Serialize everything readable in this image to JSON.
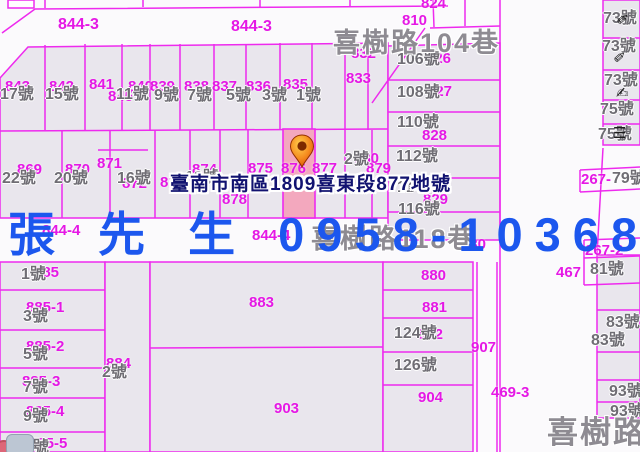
{
  "colors": {
    "bg": "#fbfafc",
    "line": "#ee2aee",
    "parcel_fill": "#e9e6ed",
    "highlight_fill": "#f3a8be",
    "parcel_label": "#e518e5",
    "house_label": "#6f6d74",
    "street_label": "#8e8b92",
    "overlay_blue": "#1c57ee",
    "tooltip_text": "#111270",
    "marker_orange": "#f07818"
  },
  "map": {
    "streets": [
      {
        "label": "喜樹路104巷",
        "x": 333,
        "y": 30,
        "size": 27
      },
      {
        "label": "喜樹路118巷",
        "x": 311,
        "y": 226,
        "size": 27
      },
      {
        "label": "喜樹路",
        "x": 547,
        "y": 417,
        "size": 31
      }
    ],
    "parcel_labels": [
      {
        "t": "844-3",
        "x": 58,
        "y": 17,
        "s": 16
      },
      {
        "t": "844-3",
        "x": 231,
        "y": 19,
        "s": 16
      },
      {
        "t": "843",
        "x": 5,
        "y": 79
      },
      {
        "t": "842",
        "x": 49,
        "y": 79
      },
      {
        "t": "841",
        "x": 89,
        "y": 77
      },
      {
        "t": "845",
        "x": 108,
        "y": 89
      },
      {
        "t": "840",
        "x": 128,
        "y": 79
      },
      {
        "t": "839",
        "x": 150,
        "y": 79
      },
      {
        "t": "838",
        "x": 184,
        "y": 79
      },
      {
        "t": "837",
        "x": 212,
        "y": 79
      },
      {
        "t": "836",
        "x": 246,
        "y": 79
      },
      {
        "t": "835",
        "x": 283,
        "y": 77
      },
      {
        "t": "832",
        "x": 351,
        "y": 46
      },
      {
        "t": "833",
        "x": 346,
        "y": 71
      },
      {
        "t": "824",
        "x": 421,
        "y": -4
      },
      {
        "t": "810",
        "x": 402,
        "y": 13
      },
      {
        "t": "826",
        "x": 426,
        "y": 51
      },
      {
        "t": "827",
        "x": 427,
        "y": 84
      },
      {
        "t": "828",
        "x": 422,
        "y": 128
      },
      {
        "t": "829",
        "x": 423,
        "y": 192
      },
      {
        "t": "830",
        "x": 461,
        "y": 237
      },
      {
        "t": "869",
        "x": 17,
        "y": 162
      },
      {
        "t": "870",
        "x": 65,
        "y": 162
      },
      {
        "t": "871",
        "x": 97,
        "y": 156
      },
      {
        "t": "872",
        "x": 122,
        "y": 176
      },
      {
        "t": "873",
        "x": 160,
        "y": 175
      },
      {
        "t": "874",
        "x": 192,
        "y": 162
      },
      {
        "t": "875",
        "x": 248,
        "y": 161
      },
      {
        "t": "876",
        "x": 281,
        "y": 161
      },
      {
        "t": "877",
        "x": 312,
        "y": 161
      },
      {
        "t": "878",
        "x": 222,
        "y": 192
      },
      {
        "t": "879",
        "x": 366,
        "y": 161
      },
      {
        "t": "880",
        "x": 354,
        "y": 151
      },
      {
        "t": "844-4",
        "x": 42,
        "y": 223
      },
      {
        "t": "844-4",
        "x": 252,
        "y": 228
      },
      {
        "t": "885",
        "x": 34,
        "y": 265
      },
      {
        "t": "885-1",
        "x": 26,
        "y": 300
      },
      {
        "t": "885-2",
        "x": 26,
        "y": 339
      },
      {
        "t": "885-3",
        "x": 22,
        "y": 374
      },
      {
        "t": "885-4",
        "x": 26,
        "y": 404
      },
      {
        "t": "885-5",
        "x": 29,
        "y": 436
      },
      {
        "t": "884",
        "x": 106,
        "y": 356
      },
      {
        "t": "883",
        "x": 249,
        "y": 295
      },
      {
        "t": "903",
        "x": 274,
        "y": 401
      },
      {
        "t": "880",
        "x": 421,
        "y": 268
      },
      {
        "t": "881",
        "x": 422,
        "y": 300
      },
      {
        "t": "882",
        "x": 418,
        "y": 327
      },
      {
        "t": "904",
        "x": 418,
        "y": 390
      },
      {
        "t": "907",
        "x": 471,
        "y": 340
      },
      {
        "t": "469-3",
        "x": 491,
        "y": 385
      },
      {
        "t": "467",
        "x": 556,
        "y": 265
      },
      {
        "t": "267-2",
        "x": 585,
        "y": 243
      },
      {
        "t": "267-",
        "x": 581,
        "y": 172
      }
    ],
    "house_labels": [
      {
        "t": "17號",
        "x": 0,
        "y": 87
      },
      {
        "t": "15號",
        "x": 45,
        "y": 87
      },
      {
        "t": "11號",
        "x": 116,
        "y": 87
      },
      {
        "t": "9號",
        "x": 154,
        "y": 88
      },
      {
        "t": "7號",
        "x": 187,
        "y": 88
      },
      {
        "t": "5號",
        "x": 226,
        "y": 88
      },
      {
        "t": "3號",
        "x": 262,
        "y": 88
      },
      {
        "t": "1號",
        "x": 296,
        "y": 88
      },
      {
        "t": "22號",
        "x": 2,
        "y": 171
      },
      {
        "t": "20號",
        "x": 54,
        "y": 171
      },
      {
        "t": "16號",
        "x": 117,
        "y": 171
      },
      {
        "t": "12號",
        "x": 185,
        "y": 170
      },
      {
        "t": "2號",
        "x": 344,
        "y": 152
      },
      {
        "t": "106號",
        "x": 397,
        "y": 52
      },
      {
        "t": "108號",
        "x": 397,
        "y": 85
      },
      {
        "t": "110號",
        "x": 397,
        "y": 115
      },
      {
        "t": "112號",
        "x": 396,
        "y": 149
      },
      {
        "t": "114號",
        "x": 397,
        "y": 180
      },
      {
        "t": "116號",
        "x": 398,
        "y": 202
      },
      {
        "t": "124號",
        "x": 394,
        "y": 326
      },
      {
        "t": "126號",
        "x": 394,
        "y": 358
      },
      {
        "t": "1號",
        "x": 21,
        "y": 267
      },
      {
        "t": "3號",
        "x": 23,
        "y": 309
      },
      {
        "t": "5號",
        "x": 23,
        "y": 347
      },
      {
        "t": "7號",
        "x": 23,
        "y": 380
      },
      {
        "t": "9號",
        "x": 23,
        "y": 409
      },
      {
        "t": "11號",
        "x": 16,
        "y": 440
      },
      {
        "t": "2號",
        "x": 102,
        "y": 365
      },
      {
        "t": "81號",
        "x": 590,
        "y": 262
      },
      {
        "t": "83號",
        "x": 606,
        "y": 315
      },
      {
        "t": "83號",
        "x": 591,
        "y": 333
      },
      {
        "t": "93號",
        "x": 609,
        "y": 384
      },
      {
        "t": "93號",
        "x": 610,
        "y": 404
      },
      {
        "t": "73號",
        "x": 603,
        "y": 11
      },
      {
        "t": "73號",
        "x": 602,
        "y": 39
      },
      {
        "t": "73號",
        "x": 604,
        "y": 73
      },
      {
        "t": "75號",
        "x": 600,
        "y": 102
      },
      {
        "t": "75號",
        "x": 598,
        "y": 127
      },
      {
        "t": "79號",
        "x": 612,
        "y": 171
      }
    ],
    "icons": [
      {
        "name": "pencil-icon",
        "glyph": "✏",
        "x": 617,
        "y": 12,
        "rot": -40
      },
      {
        "name": "pencil-icon",
        "glyph": "✏",
        "x": 614,
        "y": 50,
        "rot": -42
      },
      {
        "name": "writing-hand-icon",
        "glyph": "✍",
        "x": 616,
        "y": 86,
        "rot": 0
      },
      {
        "name": "menu-icon",
        "glyph": "☰",
        "x": 613,
        "y": 126,
        "rot": 0
      }
    ],
    "tooltip": {
      "text": "臺南市南區1809喜東段877地號",
      "x": 170,
      "y": 169
    },
    "overlay": {
      "text": "張 先 生 0958-103680",
      "x": 8,
      "y": 196
    },
    "marker": {
      "name": "map-pin",
      "parcel": "877"
    }
  }
}
